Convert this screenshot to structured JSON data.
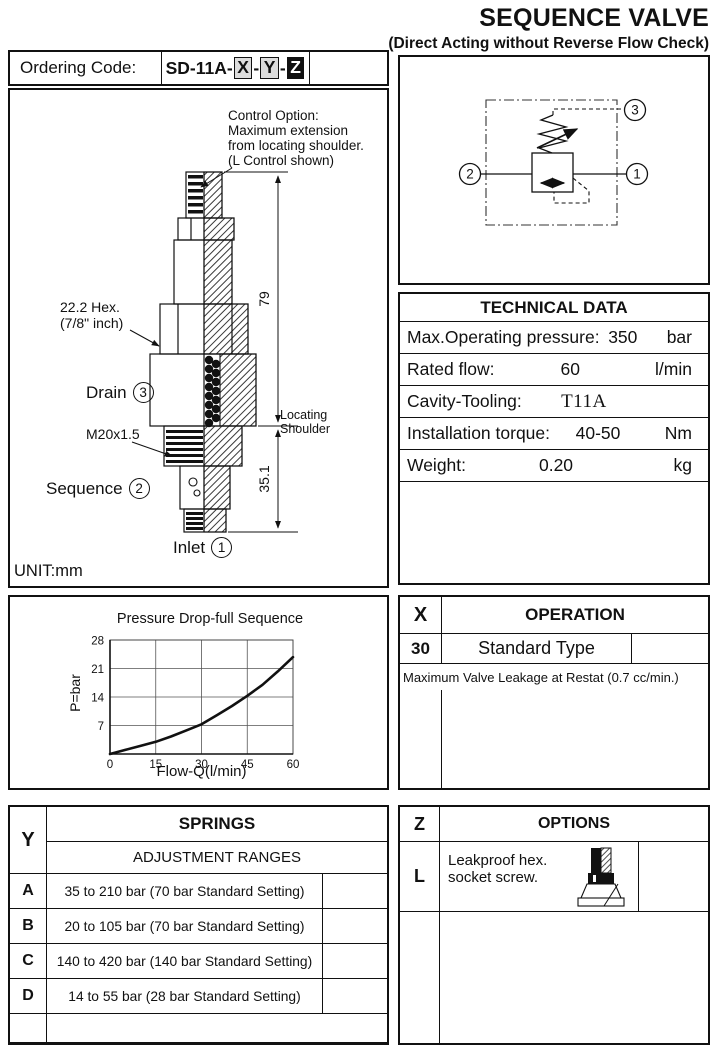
{
  "header": {
    "title": "SEQUENCE VALVE",
    "subtitle": "(Direct Acting without Reverse Flow Check)"
  },
  "ordering": {
    "label": "Ordering Code:",
    "prefix": "SD-11A-",
    "dash": "-",
    "x": "X",
    "y": "Y",
    "z": "Z"
  },
  "drawing": {
    "control_note": "Control Option:\nMaximum extension\nfrom locating shoulder.\n(L Control shown)",
    "hex_note": "22.2  Hex.\n(7/8\" inch)",
    "drain": "Drain",
    "drain_port": "3",
    "thread": "M20x1.5",
    "sequence": "Sequence",
    "sequence_port": "2",
    "inlet": "Inlet",
    "inlet_port": "1",
    "dim_height": "79",
    "dim_depth": "35.1",
    "shoulder_note": "Locating\nShoulder",
    "unit": "UNIT:mm"
  },
  "schematic": {
    "port1": "1",
    "port2": "2",
    "port3": "3"
  },
  "technical": {
    "title": "TECHNICAL DATA",
    "rows": [
      {
        "label": "Max.Operating pressure:",
        "value": "350",
        "unit": "bar"
      },
      {
        "label": "Rated flow:",
        "value": "60",
        "unit": "l/min"
      },
      {
        "label": "Cavity-Tooling:",
        "value": "T11A",
        "unit": ""
      },
      {
        "label": "Installation torque:",
        "value": "40-50",
        "unit": "Nm"
      },
      {
        "label": "Weight:",
        "value": "0.20",
        "unit": "kg"
      }
    ]
  },
  "operation": {
    "code_letter": "X",
    "title": "OPERATION",
    "rows": [
      {
        "code": "30",
        "name": "Standard Type"
      }
    ],
    "note": "Maximum Valve Leakage at Restat (0.7 cc/min.)"
  },
  "springs": {
    "code_letter": "Y",
    "title": "SPRINGS",
    "subtitle": "ADJUSTMENT RANGES",
    "rows": [
      {
        "code": "A",
        "label": "35 to 210 bar  (70 bar Standard Setting)"
      },
      {
        "code": "B",
        "label": "20 to 105 bar  (70 bar Standard Setting)"
      },
      {
        "code": "C",
        "label": "140 to 420 bar  (140 bar Standard Setting)"
      },
      {
        "code": "D",
        "label": "14 to  55  bar  (28 bar Standard Setting)"
      }
    ]
  },
  "options": {
    "code_letter": "Z",
    "title": "OPTIONS",
    "rows": [
      {
        "code": "L",
        "label": "Leakproof hex.\nsocket screw."
      }
    ]
  },
  "chart_data": {
    "type": "line",
    "title": "Pressure Drop-full Sequence",
    "xlabel": "Flow-Q(l/min)",
    "ylabel": "P=bar",
    "x": [
      0,
      5,
      10,
      15,
      20,
      25,
      30,
      35,
      40,
      45,
      50,
      55,
      60
    ],
    "y": [
      0,
      1,
      2,
      3,
      4.3,
      5.8,
      7.3,
      9.5,
      11.8,
      14.3,
      17,
      20.3,
      23.8
    ],
    "xlim": [
      0,
      60
    ],
    "ylim": [
      0,
      28
    ],
    "xticks": [
      0,
      15,
      30,
      45,
      60
    ],
    "yticks": [
      0,
      7,
      14,
      21,
      28
    ],
    "grid": true,
    "legend": "none"
  }
}
